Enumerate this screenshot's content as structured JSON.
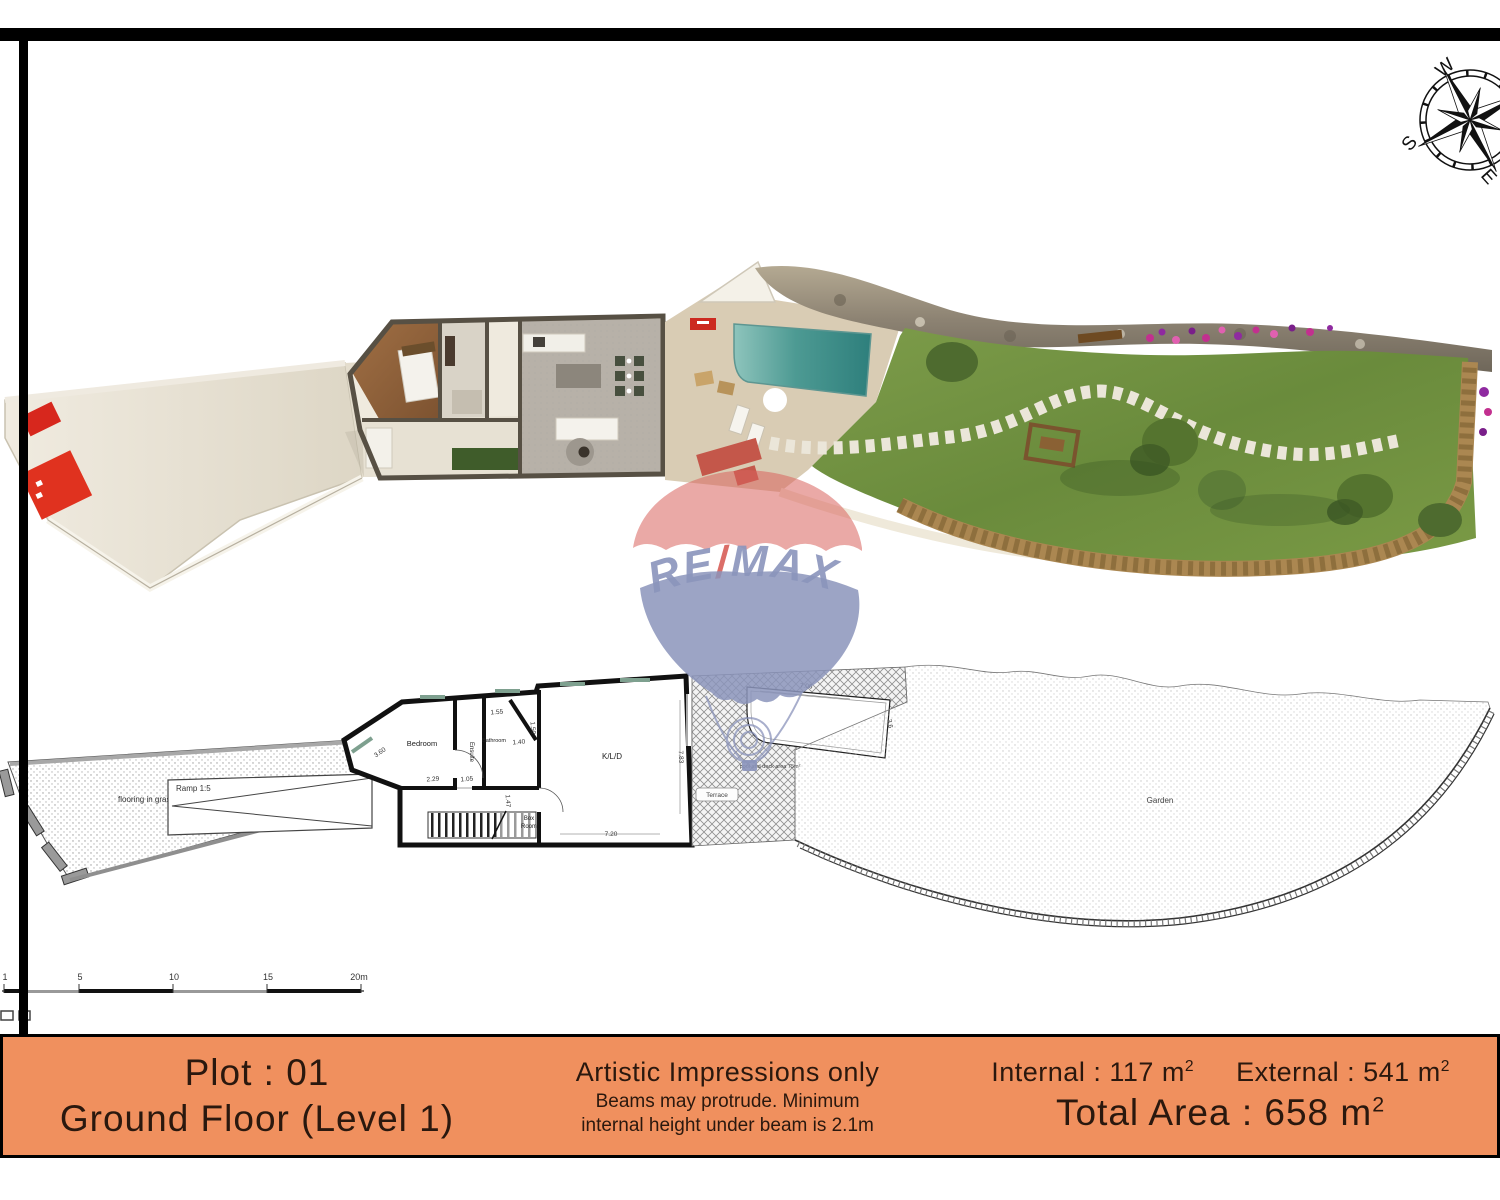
{
  "colors": {
    "footer_bg": "#f0905e",
    "footer_text": "#2a180e",
    "remax_red": "#d9625c",
    "remax_blue": "#8d96bd",
    "pool_teal": "#3f8f8a",
    "lawn_green": "#6f8f3f",
    "panel_red": "#e0321f"
  },
  "compass": {
    "w": "W",
    "s": "S",
    "e": "E"
  },
  "watermark": {
    "re": "RE",
    "slash": "/",
    "max": "MAX"
  },
  "plan": {
    "labels": {
      "grass": "flooring in grass blocks",
      "ramp": "Ramp 1:5",
      "bedroom": "Bedroom",
      "ensuite": "Ensuite",
      "bathroom": "Bathroom",
      "kld": "K/L/D",
      "box1": "Box",
      "box2": "Room",
      "terrace": "Terrace",
      "pool_note": "pool and deck area 75m²",
      "garden": "Garden"
    },
    "dims": [
      "3.60",
      "2.29",
      "1.05",
      "1.55",
      "1.40",
      "1.50",
      "1.47",
      "7.20",
      "7.83",
      "7.06",
      "3.6"
    ]
  },
  "scalebar": {
    "labels": [
      "1",
      "2",
      "5",
      "10",
      "15",
      "20m"
    ]
  },
  "footer": {
    "plot": "Plot : 01",
    "floor": "Ground Floor (Level 1)",
    "disclaimer_title": "Artistic Impressions only",
    "disclaimer_line1": "Beams may protrude. Minimum",
    "disclaimer_line2": "internal height under beam is 2.1m",
    "internal": "Internal : 117 m",
    "internal_sup": "2",
    "external": "External : 541 m",
    "external_sup": "2",
    "total": "Total Area : 658 m",
    "total_sup": "2"
  }
}
